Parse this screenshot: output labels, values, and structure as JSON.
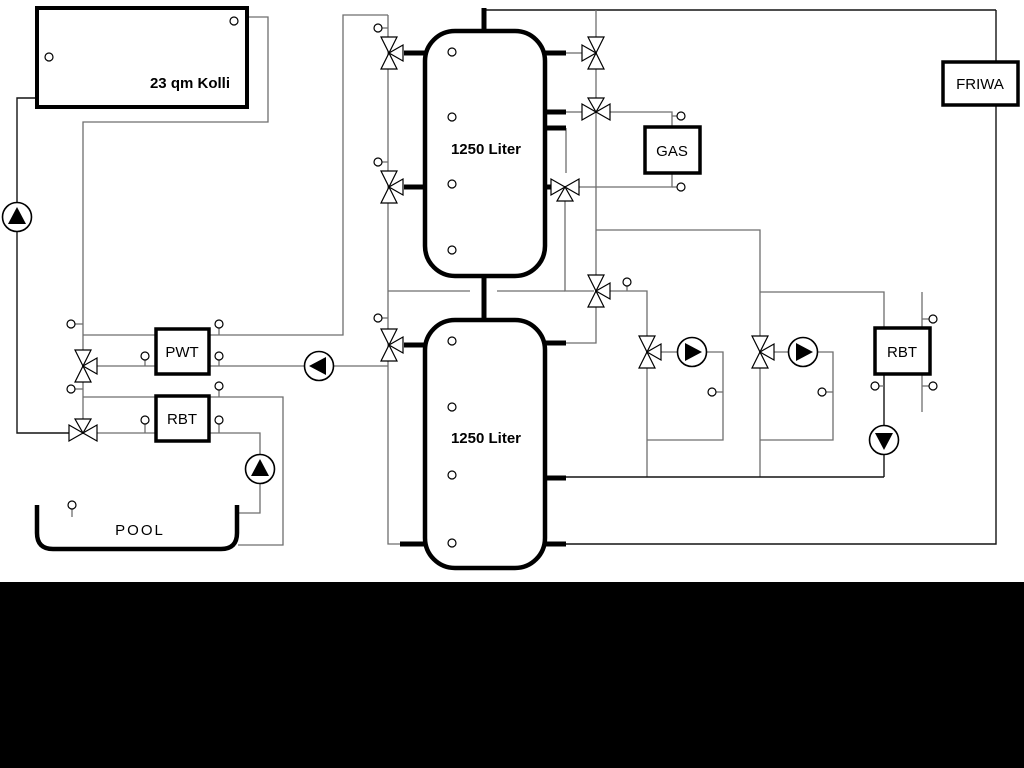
{
  "labels": {
    "collector": "23 qm Kolli",
    "tank_top": "1250 Liter",
    "tank_bottom": "1250 Liter",
    "gas": "GAS",
    "friwa": "FRIWA",
    "pwt": "PWT",
    "rbt_left": "RBT",
    "rbt_right": "RBT",
    "pool": "POOL"
  },
  "colors": {
    "background": "#ffffff",
    "footer_band": "#000000",
    "pipe": "#6e6e6e",
    "pipe_dark": "#141414",
    "component_stroke": "#000000"
  },
  "icons": {
    "pump": "circle-with-solid-triangle",
    "three_way_valve": "bowtie-double-triangle",
    "sensor": "small-circle-with-stub"
  }
}
